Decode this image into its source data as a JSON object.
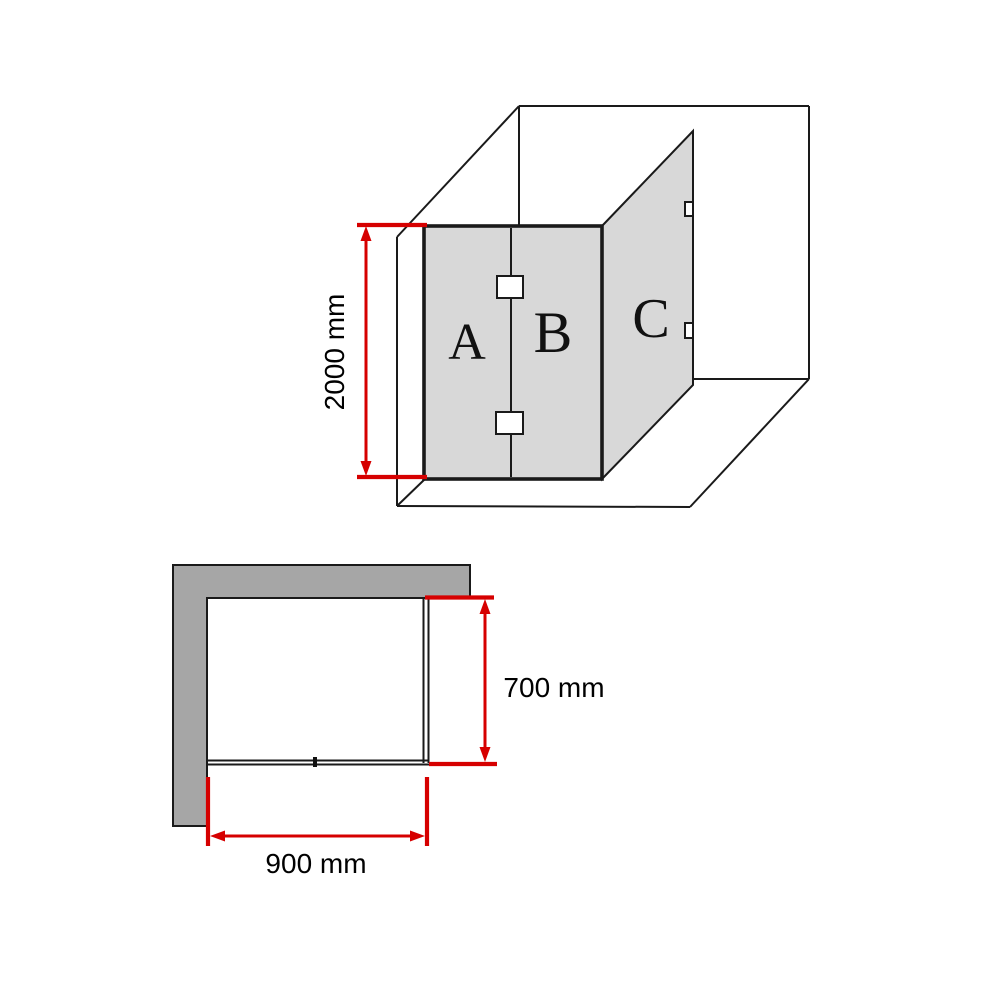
{
  "elevation_view": {
    "panel_a_label": "A",
    "panel_b_label": "B",
    "panel_c_label": "C",
    "height_dimension": "2000 mm"
  },
  "plan_view": {
    "depth_dimension": "700 mm",
    "width_dimension": "900 mm"
  },
  "colors": {
    "dimension_red": "#d60000",
    "glass_panel_gray": "#d8d8d8",
    "wall_gray": "#a6a6a6",
    "line_black": "#1a1a1a",
    "background": "#ffffff"
  }
}
